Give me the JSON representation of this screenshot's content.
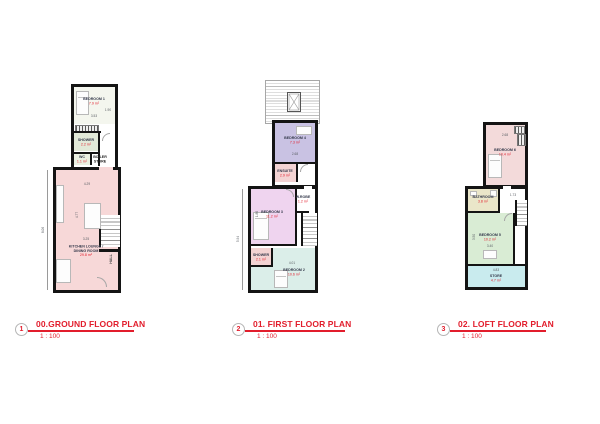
{
  "sheet": {
    "bg": "#ffffff",
    "accent_red": "#e21d2c",
    "wall_color": "#141414"
  },
  "plans": [
    {
      "number": "1",
      "title": "00.GROUND FLOOR PLAN",
      "scale": "1 : 100",
      "hall_label": "HALL",
      "rooms": [
        {
          "name": "BEDROOM 1",
          "area": "7.9 m²",
          "color": "#f4f6ee"
        },
        {
          "name": "SHOWER",
          "area": "2.2 m²",
          "color": "#e2e9d8"
        },
        {
          "name": "WC",
          "area": "1.1 m²",
          "color": "#eaf0e2"
        },
        {
          "name": "BOILER",
          "name2": "STORE",
          "color": "#ffffff"
        },
        {
          "name": "KITCHEN LOUNGE /",
          "name2": "DINING ROOM",
          "area": "29.8 m²",
          "color": "#f7d8d8"
        }
      ],
      "dims": [
        "3.53",
        "1.90",
        "4.29",
        "4.77",
        "3.25",
        "8.06"
      ]
    },
    {
      "number": "2",
      "title": "01. FIRST FLOOR PLAN",
      "scale": "1 : 100",
      "rooms": [
        {
          "name": "BEDROOM 4",
          "area": "7.3 m²",
          "color": "#c9c2e3"
        },
        {
          "name": "ENSUITE",
          "area": "2.9 m²",
          "color": "#f3d3d3"
        },
        {
          "name": "BEDROOM 3",
          "area": "11.2 m²",
          "color": "#efd4ef"
        },
        {
          "name": "W.ROBE",
          "area": "1.2 m²",
          "color": "#ffffff"
        },
        {
          "name": "SHOWER",
          "area": "2.1 m²",
          "color": "#f3d3d3"
        },
        {
          "name": "BEDROOM 2",
          "area": "10.6 m²",
          "color": "#dbeee9"
        }
      ],
      "dims": [
        "2.68",
        "1.86",
        "4.01",
        "5.94"
      ]
    },
    {
      "number": "3",
      "title": "02. LOFT FLOOR PLAN",
      "scale": "1 : 100",
      "rooms": [
        {
          "name": "BEDROOM 6",
          "area": "10.4 m²",
          "color": "#f3dada"
        },
        {
          "name": "BATHROOM",
          "area": "3.8 m²",
          "color": "#eae6c9"
        },
        {
          "name": "BEDROOM 5",
          "area": "10.2 m²",
          "color": "#d9ecd4"
        },
        {
          "name": "STORE",
          "area": "4.7 m²",
          "color": "#c9ebee"
        }
      ],
      "dims": [
        "2.68",
        "1.73",
        "3.40",
        "4.83",
        "3.50"
      ]
    }
  ]
}
